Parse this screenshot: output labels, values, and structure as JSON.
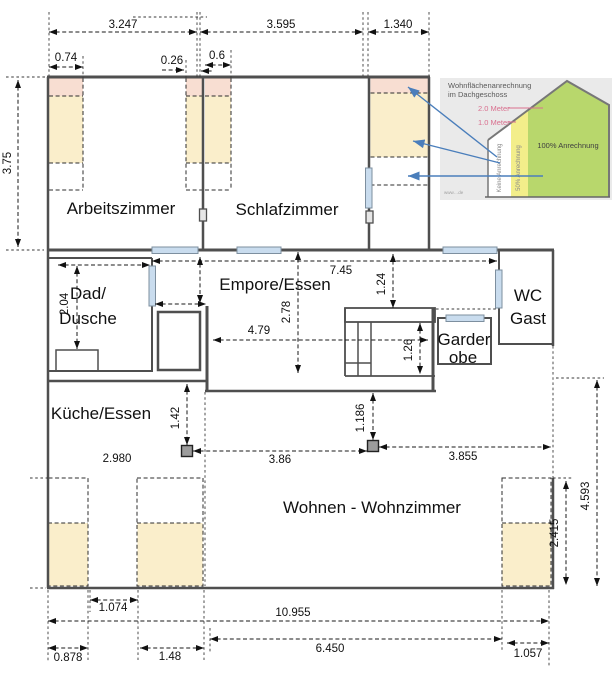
{
  "title": "Dachgeschoss Grundriss",
  "rooms": {
    "arbeitszimmer": "Arbeitszimmer",
    "schlafzimmer": "Schlafzimmer",
    "empore": "Empore/Essen",
    "bad_line1": "Dad/",
    "bad_line2": "Dusche",
    "wc_line1": "WC",
    "wc_line2": "Gast",
    "garderobe_line1": "Garder",
    "garderobe_line2": "obe",
    "kueche": "Küche/Essen",
    "wohnen": "Wohnen - Wohnzimmer"
  },
  "dims": {
    "w_3247": "3.247",
    "w_3595": "3.595",
    "w_1340": "1.340",
    "w_074": "0.74",
    "w_026": "0.26",
    "w_06": "0.6",
    "h_375": "3.75",
    "w_745": "7.45",
    "h_124": "1.24",
    "h_204": "2.04",
    "w_479": "4.79",
    "h_278": "2.78",
    "h_126": "1.26",
    "h_142": "1.42",
    "w_2980": "2.980",
    "w_386": "3.86",
    "h_1186": "1.186",
    "w_3855": "3.855",
    "h_4593": "4.593",
    "h_2415": "2.415",
    "w_1074": "1.074",
    "w_10955": "10.955",
    "w_0878": "0.878",
    "w_148": "1.48",
    "w_6450": "6.450",
    "w_1057": "1.057"
  },
  "legend": {
    "title_line1": "Wohnflächenanrechnung",
    "title_line2": "im Dachgeschoss",
    "meter_2": "2.0 Meter",
    "meter_1": "1.0 Meter",
    "zone_none": "Keine Anrechnung",
    "zone_half": "50% Anrechnung",
    "zone_full": "100% Anrechnung",
    "watermark": "www…de"
  },
  "colors": {
    "zone_yellow": "#faeecb",
    "zone_pink": "#f8ded2",
    "window_blue": "#c9dcee",
    "wall_gray": "#4f4f4f",
    "legend_green": "#b8d76c",
    "legend_yellow": "#f3ee8a",
    "legend_bg": "#eaeaea",
    "arrow_blue": "#4a7ebb",
    "meter_pink": "#d9708f"
  }
}
